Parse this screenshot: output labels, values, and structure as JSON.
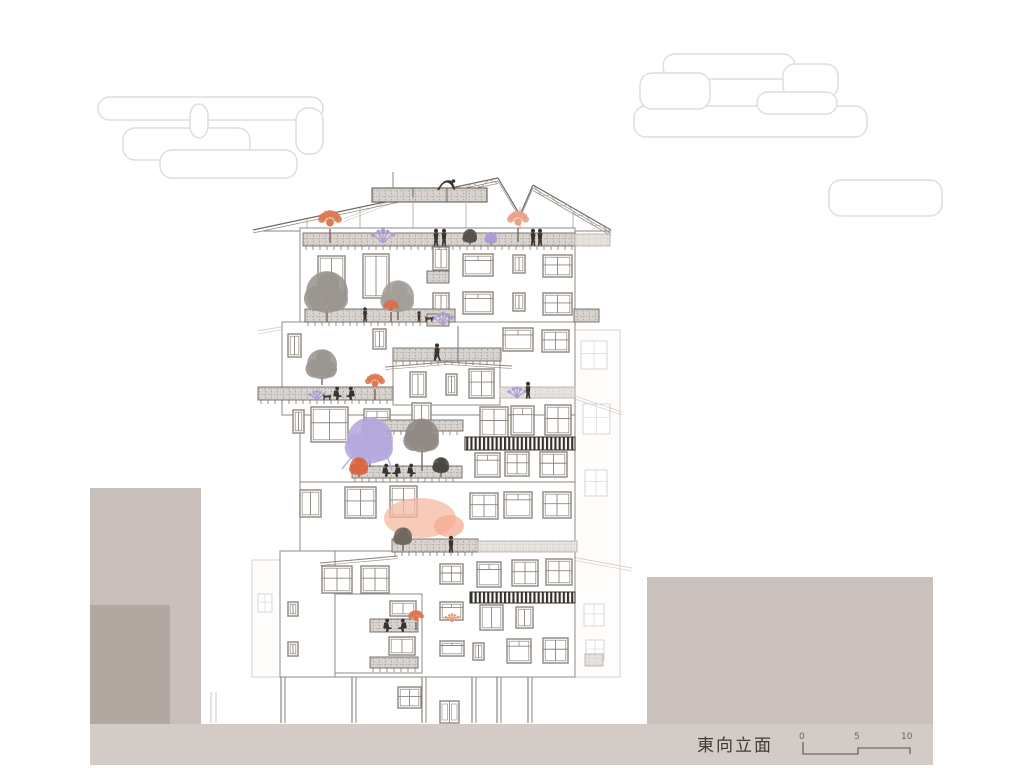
{
  "title": {
    "text": "東向立面"
  },
  "scalebar": {
    "labels": [
      "0",
      "5",
      "10"
    ]
  },
  "colors": {
    "line": "#8d857e",
    "faint": "#d6d1cc",
    "dark": "#57504a",
    "ground": "#d3cbc6",
    "mass1": "#c8bfba",
    "mass1d": "#b1a8a2",
    "mass2": "#cac1bc",
    "cloud": "#dedede",
    "stripe": "#332f2a",
    "people": "#3a3430",
    "purple": "#ab9cd6",
    "purple2": "#b4a7dc",
    "orange": "#dd7a52",
    "peach": "#f6b9a2",
    "salmon": "#eda184",
    "gray_tree": "#9a948e",
    "red_tree": "#d96f4f"
  },
  "scene": {
    "clouds": [
      {
        "name": "cloud-left",
        "rects": [
          [
            98,
            97,
            225,
            23
          ],
          [
            123,
            128,
            127,
            32
          ],
          [
            160,
            150,
            137,
            28
          ],
          [
            296,
            108,
            27,
            46
          ],
          [
            190,
            104,
            18,
            34
          ]
        ]
      },
      {
        "name": "cloud-right",
        "rects": [
          [
            663,
            54,
            132,
            25
          ],
          [
            783,
            64,
            55,
            34
          ],
          [
            634,
            106,
            233,
            31
          ],
          [
            757,
            92,
            80,
            22
          ],
          [
            640,
            73,
            70,
            36
          ]
        ]
      },
      {
        "name": "cloud-small",
        "rects": [
          [
            829,
            180,
            113,
            36
          ]
        ]
      }
    ],
    "background": {
      "rects": [
        [
          575,
          330,
          45,
          347
        ],
        [
          252,
          560,
          30,
          117
        ]
      ],
      "windows": [
        [
          581,
          341,
          26,
          28
        ],
        [
          583,
          404,
          27,
          30
        ],
        [
          585,
          470,
          22,
          26
        ],
        [
          584,
          604,
          20,
          22
        ],
        [
          586,
          640,
          18,
          20
        ],
        [
          258,
          594,
          14,
          18
        ]
      ],
      "lines": [
        [
          572,
          557,
          632,
          568
        ],
        [
          575,
          396,
          622,
          412
        ],
        [
          343,
          219,
          393,
          200
        ],
        [
          258,
          331,
          302,
          323
        ]
      ],
      "columns": [
        [
          211,
          692
        ],
        [
          216,
          692
        ]
      ]
    },
    "masses": [
      [
        90,
        488,
        111,
        237,
        "mass1"
      ],
      [
        90,
        605,
        80,
        119,
        "mass1d"
      ],
      [
        647,
        577,
        286,
        148,
        "mass2"
      ]
    ],
    "ground": [
      90,
      724,
      843,
      41
    ],
    "roof": {
      "slopes": [
        [
          [
            253,
            230
          ],
          [
            498,
            178
          ]
        ],
        [
          [
            498,
            178
          ],
          [
            520,
            215
          ]
        ],
        [
          [
            520,
            215
          ],
          [
            533,
            185
          ]
        ],
        [
          [
            533,
            185
          ],
          [
            611,
            230
          ]
        ]
      ],
      "eave": [
        262,
        231,
        611
      ],
      "box": [
        372,
        188,
        115,
        14
      ],
      "box_divs": [
        413,
        447
      ],
      "pole": [
        393,
        172,
        393,
        188
      ],
      "ladders": [
        {
          "from": [
            420,
            194
          ],
          "to": [
            498,
            178
          ]
        },
        {
          "from": [
            533,
            185
          ],
          "to": [
            611,
            230
          ]
        }
      ],
      "posts": [
        [
          307,
          219
        ],
        [
          360,
          208
        ],
        [
          413,
          197
        ],
        [
          466,
          186
        ],
        [
          520,
          207
        ],
        [
          573,
          210
        ]
      ]
    },
    "walls": [
      [
        300,
        228,
        275,
        102
      ],
      [
        282,
        322,
        293,
        93
      ],
      [
        300,
        415,
        275,
        67
      ],
      [
        300,
        482,
        275,
        73
      ],
      [
        320,
        551,
        255,
        126
      ],
      [
        280,
        551,
        55,
        126
      ],
      [
        393,
        360,
        107,
        45
      ],
      [
        335,
        594,
        87,
        79
      ]
    ],
    "windows": [
      [
        318,
        256,
        27,
        42,
        "v2"
      ],
      [
        363,
        254,
        26,
        44,
        "v2"
      ],
      [
        433,
        247,
        16,
        23,
        "v2"
      ],
      [
        463,
        254,
        30,
        22,
        "h2"
      ],
      [
        513,
        255,
        12,
        18,
        "v1"
      ],
      [
        543,
        255,
        29,
        22,
        "cross"
      ],
      [
        433,
        293,
        16,
        23,
        "v2"
      ],
      [
        463,
        292,
        30,
        22,
        "h2"
      ],
      [
        513,
        293,
        12,
        18,
        "v1"
      ],
      [
        543,
        293,
        29,
        22,
        "cross"
      ],
      [
        288,
        334,
        13,
        23,
        "v1"
      ],
      [
        373,
        329,
        13,
        20,
        "v1"
      ],
      [
        503,
        328,
        30,
        23,
        "h2"
      ],
      [
        542,
        330,
        27,
        22,
        "cross"
      ],
      [
        410,
        372,
        16,
        25,
        "v2"
      ],
      [
        446,
        374,
        11,
        21,
        "v1"
      ],
      [
        469,
        369,
        25,
        29,
        "cross"
      ],
      [
        293,
        410,
        11,
        23,
        "v1"
      ],
      [
        311,
        407,
        37,
        35,
        "cross"
      ],
      [
        364,
        409,
        26,
        29,
        "h2"
      ],
      [
        412,
        403,
        19,
        28,
        "v2"
      ],
      [
        480,
        407,
        28,
        30,
        "cross"
      ],
      [
        511,
        406,
        23,
        29,
        "h2"
      ],
      [
        545,
        405,
        26,
        30,
        "cross"
      ],
      [
        300,
        490,
        21,
        27,
        "v2"
      ],
      [
        345,
        487,
        31,
        31,
        "cross"
      ],
      [
        390,
        486,
        27,
        31,
        "cross"
      ],
      [
        475,
        453,
        25,
        24,
        "h2"
      ],
      [
        505,
        452,
        24,
        24,
        "cross"
      ],
      [
        540,
        452,
        27,
        25,
        "cross"
      ],
      [
        470,
        493,
        28,
        26,
        "cross"
      ],
      [
        504,
        492,
        28,
        26,
        "h2"
      ],
      [
        543,
        492,
        28,
        26,
        "cross"
      ],
      [
        322,
        566,
        30,
        27,
        "cross"
      ],
      [
        361,
        566,
        28,
        27,
        "cross"
      ],
      [
        440,
        564,
        23,
        20,
        "cross"
      ],
      [
        477,
        562,
        24,
        25,
        "h2"
      ],
      [
        512,
        560,
        26,
        26,
        "cross"
      ],
      [
        546,
        559,
        26,
        26,
        "cross"
      ],
      [
        480,
        605,
        23,
        25,
        "v2"
      ],
      [
        516,
        607,
        17,
        21,
        "v2"
      ],
      [
        440,
        602,
        23,
        18,
        "h2"
      ],
      [
        288,
        602,
        10,
        14,
        "v1"
      ],
      [
        288,
        642,
        10,
        14,
        "v1"
      ],
      [
        390,
        601,
        26,
        15,
        "v2"
      ],
      [
        389,
        637,
        26,
        18,
        "v2"
      ],
      [
        440,
        641,
        24,
        15,
        "h2"
      ],
      [
        473,
        643,
        11,
        17,
        "v1"
      ],
      [
        507,
        639,
        24,
        24,
        "h2"
      ],
      [
        543,
        638,
        25,
        25,
        "cross"
      ],
      [
        398,
        687,
        23,
        21,
        "cross"
      ]
    ],
    "bands": [
      [
        303,
        233,
        272,
        13,
        "p"
      ],
      [
        575,
        234,
        35,
        12,
        "l"
      ],
      [
        305,
        309,
        150,
        13,
        "p"
      ],
      [
        427,
        271,
        22,
        12,
        ""
      ],
      [
        427,
        314,
        22,
        12,
        ""
      ],
      [
        574,
        309,
        25,
        13,
        ""
      ],
      [
        393,
        348,
        108,
        13,
        "p"
      ],
      [
        258,
        387,
        135,
        13,
        "p"
      ],
      [
        500,
        387,
        75,
        11,
        "l"
      ],
      [
        363,
        420,
        100,
        11,
        "p"
      ],
      [
        352,
        466,
        110,
        12,
        "p"
      ],
      [
        392,
        539,
        86,
        13,
        "p"
      ],
      [
        478,
        541,
        99,
        11,
        "l"
      ],
      [
        370,
        619,
        48,
        13,
        ""
      ],
      [
        370,
        657,
        48,
        11,
        "p"
      ],
      [
        585,
        654,
        18,
        12,
        "l"
      ]
    ],
    "awnings": [
      [
        465,
        437,
        110,
        13
      ],
      [
        470,
        592,
        105,
        11
      ]
    ],
    "canopies": [
      [
        385,
        367,
        447,
        362
      ],
      [
        447,
        362,
        512,
        366
      ],
      [
        320,
        563,
        398,
        556
      ]
    ],
    "lines": [
      [
        458,
        326,
        458,
        362
      ]
    ],
    "trees": [
      {
        "t": "spiky",
        "x": 330,
        "y": 243,
        "r": 12,
        "tr": 12,
        "c": "orange"
      },
      {
        "t": "spray",
        "x": 383,
        "y": 243,
        "r": 10,
        "c": "purple"
      },
      {
        "t": "spiky",
        "x": 518,
        "y": 242,
        "r": 11,
        "tr": 12,
        "c": "salmon"
      },
      {
        "t": "round",
        "x": 470,
        "y": 245,
        "r": 7,
        "tr": 3,
        "c": "#57504a"
      },
      {
        "t": "round",
        "x": 491,
        "y": 245,
        "r": 6,
        "tr": 2,
        "c": "purple"
      },
      {
        "t": "round",
        "x": 327,
        "y": 322,
        "r": 21,
        "tr": 12,
        "c": "gray_tree"
      },
      {
        "t": "round",
        "x": 398,
        "y": 320,
        "r": 16,
        "tr": 10,
        "c": "#a39d97"
      },
      {
        "t": "spiky",
        "x": 391,
        "y": 322,
        "r": 8,
        "tr": 8,
        "c": "red_tree"
      },
      {
        "t": "spray",
        "x": 443,
        "y": 325,
        "r": 9,
        "c": "purple"
      },
      {
        "t": "round",
        "x": 322,
        "y": 385,
        "r": 15,
        "tr": 8,
        "c": "gray_tree"
      },
      {
        "t": "spray",
        "x": 317,
        "y": 400,
        "r": 7,
        "c": "purple"
      },
      {
        "t": "spiky",
        "x": 375,
        "y": 400,
        "r": 10,
        "tr": 9,
        "c": "orange"
      },
      {
        "t": "spray",
        "x": 517,
        "y": 398,
        "r": 8,
        "c": "purple"
      },
      {
        "t": "frond",
        "x": 370,
        "y": 467,
        "r": 23,
        "tr": 7,
        "c": "purple2"
      },
      {
        "t": "round",
        "x": 422,
        "y": 471,
        "r": 17,
        "tr": 21,
        "c": "#8f8983"
      },
      {
        "t": "round",
        "x": 359,
        "y": 477,
        "r": 9,
        "tr": 3,
        "c": "#d96540"
      },
      {
        "t": "round",
        "x": 441,
        "y": 477,
        "r": 8,
        "tr": 5,
        "c": "#4a4540"
      },
      {
        "t": "blob",
        "x": 420,
        "y": 518,
        "rx": 36,
        "ry": 20,
        "c": "peach"
      },
      {
        "t": "blob",
        "x": 449,
        "y": 526,
        "rx": 15,
        "ry": 11,
        "c": "#f3ab90"
      },
      {
        "t": "round",
        "x": 403,
        "y": 551,
        "r": 9,
        "tr": 7,
        "c": "#6e685c"
      },
      {
        "t": "spiky",
        "x": 416,
        "y": 630,
        "r": 8,
        "tr": 6,
        "c": "#e0764e"
      },
      {
        "t": "spray",
        "x": 452,
        "y": 622,
        "r": 6,
        "c": "#e89a77"
      }
    ],
    "people": [
      {
        "p": "bend",
        "x": 446,
        "y": 190
      },
      {
        "p": "stand",
        "x": 436,
        "y": 246
      },
      {
        "p": "stand",
        "x": 444,
        "y": 246
      },
      {
        "p": "stand",
        "x": 533,
        "y": 246
      },
      {
        "p": "stand",
        "x": 540,
        "y": 246
      },
      {
        "p": "stand",
        "x": 365,
        "y": 322,
        "s": 0.85
      },
      {
        "p": "kid",
        "x": 419,
        "y": 322
      },
      {
        "p": "dog",
        "x": 429,
        "y": 322
      },
      {
        "p": "walk",
        "x": 437,
        "y": 361
      },
      {
        "p": "stand",
        "x": 528,
        "y": 399
      },
      {
        "p": "sit",
        "x": 336,
        "y": 400
      },
      {
        "p": "sitR",
        "x": 352,
        "y": 400
      },
      {
        "p": "dog",
        "x": 327,
        "y": 400
      },
      {
        "p": "sit",
        "x": 385,
        "y": 477
      },
      {
        "p": "sitR",
        "x": 398,
        "y": 477
      },
      {
        "p": "sit",
        "x": 410,
        "y": 477
      },
      {
        "p": "stand",
        "x": 451,
        "y": 553
      },
      {
        "p": "sit",
        "x": 386,
        "y": 632
      },
      {
        "p": "sitR",
        "x": 404,
        "y": 632
      }
    ],
    "columns": [
      [
        281,
        677
      ],
      [
        352,
        677
      ],
      [
        422,
        677
      ],
      [
        472,
        677
      ],
      [
        497,
        677
      ],
      [
        528,
        677
      ]
    ],
    "door": [
      440,
      701,
      19,
      22
    ],
    "scalebar_path": "M803,742 L803,754 L858,754 L858,748 L910,748 L910,754"
  }
}
